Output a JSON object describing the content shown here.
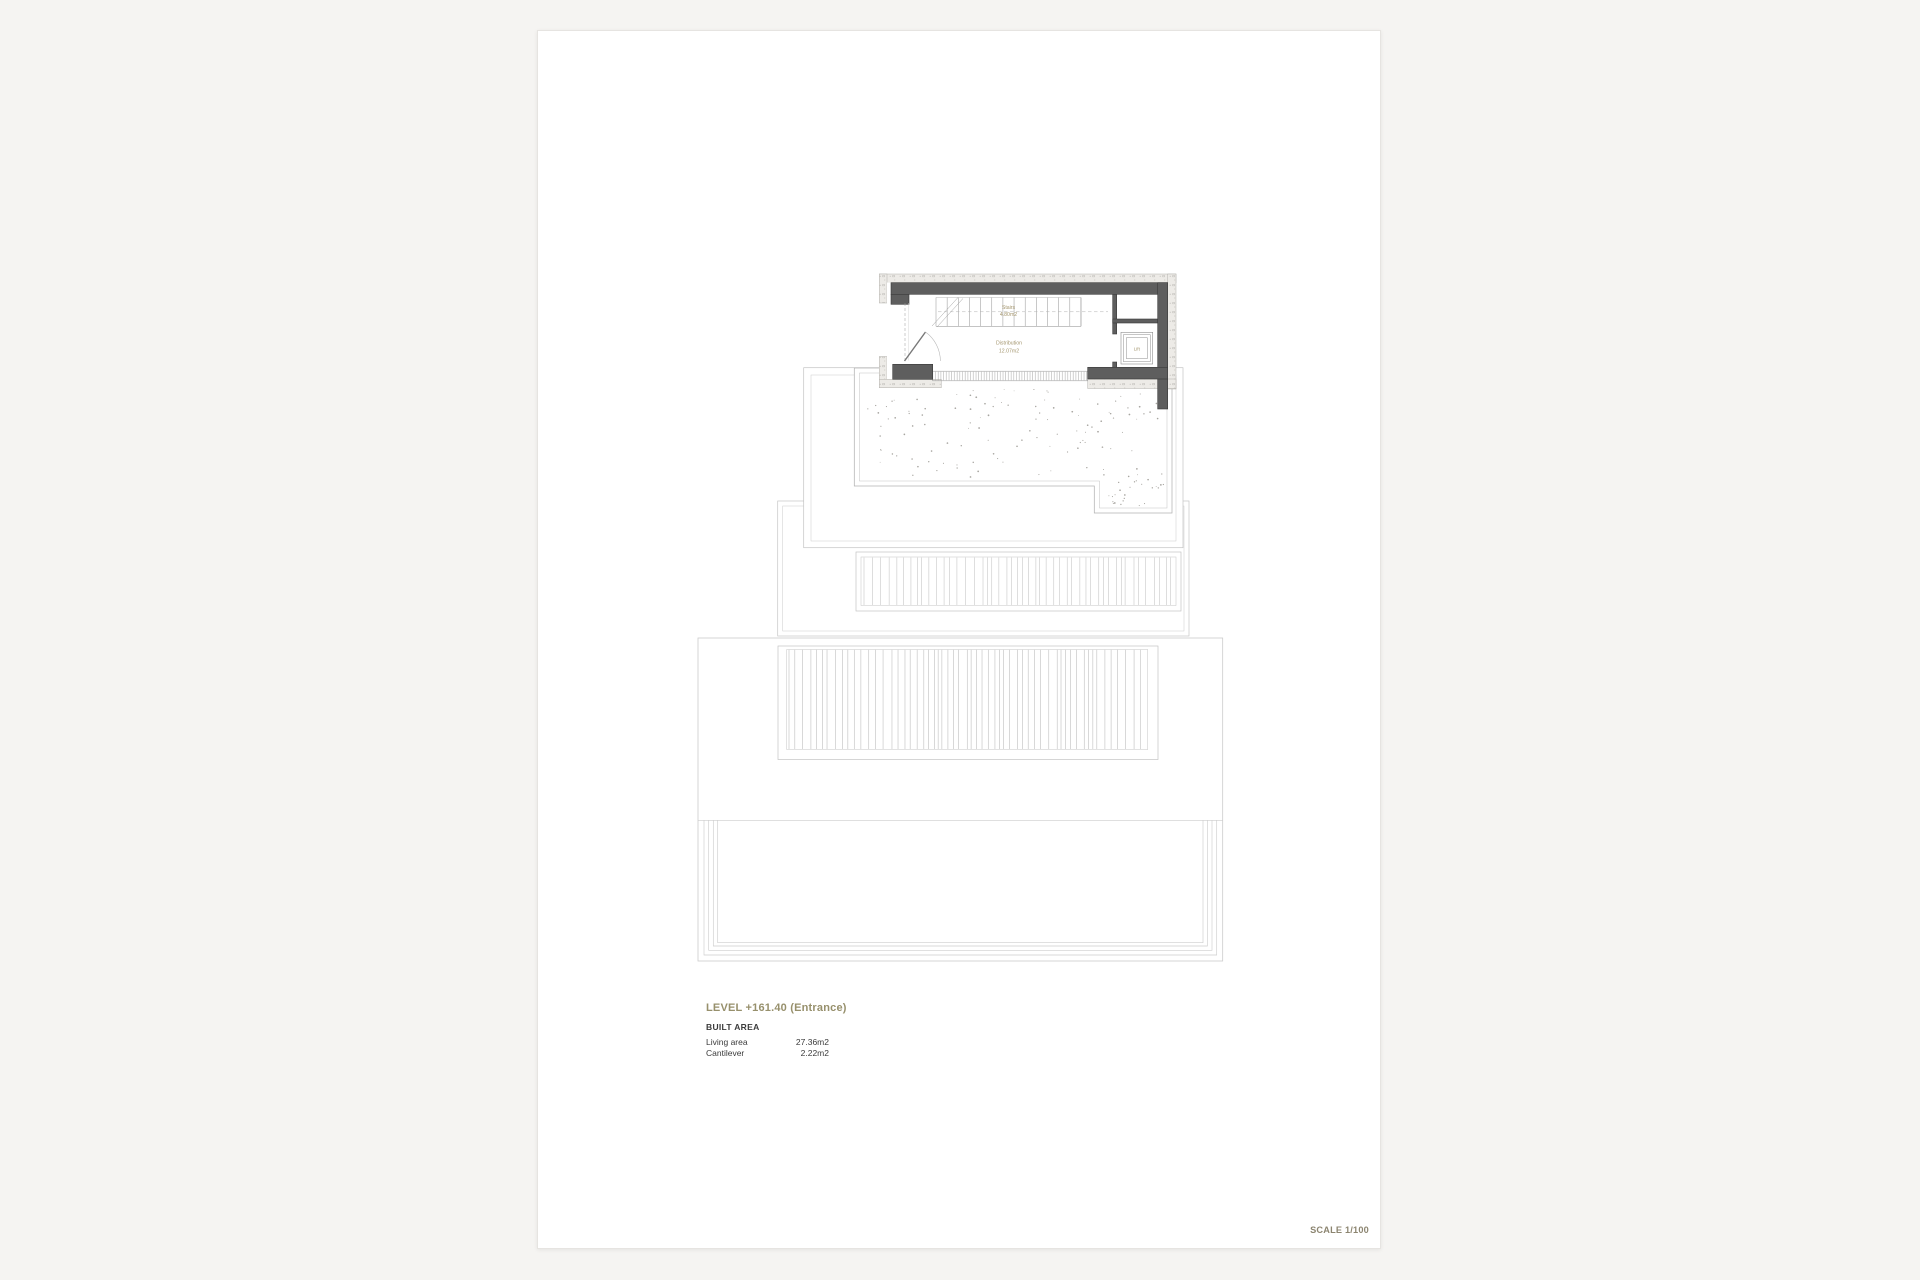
{
  "plan": {
    "stairs_label": "Stairs",
    "stairs_area": "4.80m2",
    "distribution_label": "Distribution",
    "distribution_area": "12.07m2",
    "lift_label": "Lift"
  },
  "legend": {
    "level_title": "LEVEL +161.40 (Entrance)",
    "built_area_heading": "BUILT AREA",
    "rows": [
      {
        "label": "Living area",
        "value": "27.36m2"
      },
      {
        "label": "Cantilever",
        "value": "2.22m2"
      }
    ]
  },
  "scale_label": "SCALE 1/100",
  "colors": {
    "accent_olive": "#97906C",
    "plan_label_olive": "#A4966E",
    "wall_gray": "#5E5E5E",
    "outline_light": "#C8C8C8",
    "text_dark": "#3B3B3B",
    "sheet_white": "#FFFFFF",
    "page_background": "#F5F4F2"
  }
}
